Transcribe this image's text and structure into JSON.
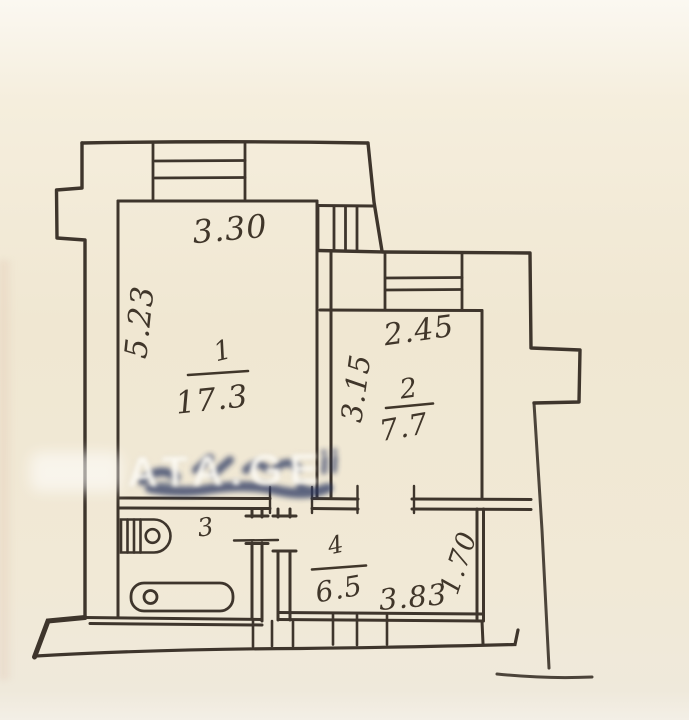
{
  "plan": {
    "type": "floor-plan",
    "paper_color": "#f1e8d4",
    "ink_color": "#3e352c",
    "rooms": {
      "r1": {
        "number": "1",
        "area": "17.3",
        "width": "3.30",
        "height": "5.23"
      },
      "r2": {
        "number": "2",
        "area": "7.7",
        "width": "2.45",
        "height": "3.15"
      },
      "r3": {
        "number": "3"
      },
      "r4": {
        "number": "4",
        "area": "6.5",
        "width": "3.83",
        "height": "1.70"
      }
    },
    "fixtures": [
      "washbasin",
      "bathtub"
    ],
    "watermark": {
      "text": "ATA.GE",
      "ink_color": "#2c3862"
    }
  }
}
